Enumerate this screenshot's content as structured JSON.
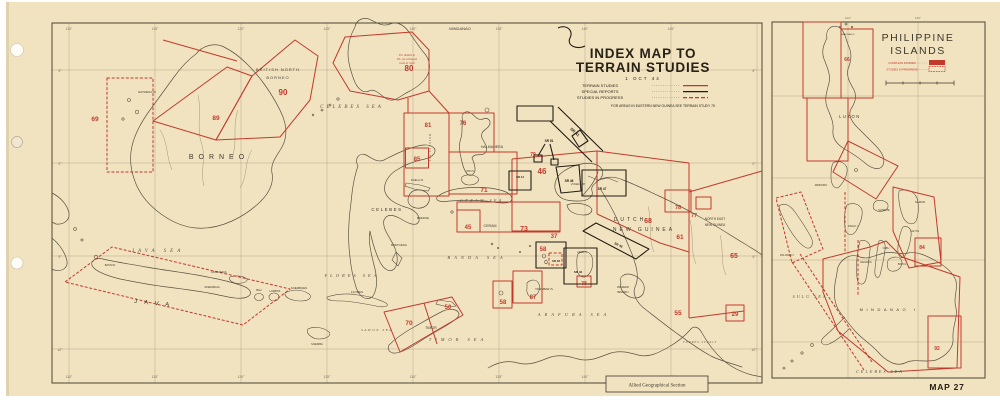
{
  "sheet": {
    "map_number": "MAP 27",
    "credit": "Allied Geographical Section"
  },
  "colors": {
    "paper": "#f2e3c0",
    "map_line": "#5a5343",
    "study_red": "#c13a2c",
    "report_black": "#221d14"
  },
  "main_map": {
    "title_line1": "INDEX MAP TO",
    "title_line2": "TERRAIN STUDIES",
    "date": "1 OCT 44",
    "legend": {
      "terrain_studies": "TERRAIN STUDIES",
      "special_reports": "SPECIAL REPORTS",
      "studies_in_progress": "STUDIES IN PROGRESS"
    },
    "footnote": "FOR AREAS IN EASTERN NEW GUINEA SEE TERRAIN STUDY 79",
    "inset_note": [
      "For details in",
      "P.I. see enlarged",
      "inset at right"
    ],
    "sea_labels": [
      "CELEBES SEA",
      "JAVA SEA",
      "FLORES SEA",
      "BANDA SEA",
      "CERAM SEA",
      "TIMOR SEA",
      "ARAFURA SEA",
      "SAWOE SEA",
      "TORRES STRAIT",
      "MOLUCCA SEA"
    ],
    "place_labels": [
      "BORNEO",
      "BRITISH NORTH",
      "BORNEO",
      "NATOENA IS",
      "MINDANAO",
      "CELEBES",
      "HALMAHERA",
      "CERAM",
      "BOEROE",
      "SOELA IS",
      "BOETOENG",
      "MADOERA",
      "JAVA",
      "BALI",
      "LOMBOK",
      "SOEMBAWA",
      "FLORES",
      "SOEMBA",
      "TIMOR",
      "TANIMBAR IS",
      "DUTCH",
      "NEW GUINEA",
      "NORTH EAST",
      "NEW GUINEA",
      "VOGELKOP",
      "FREDERIK",
      "HENDRIK I",
      "OBI IS",
      "AROE IS",
      "BATAVIA",
      "SOERABAJA"
    ],
    "study_numbers": [
      "90",
      "89",
      "69",
      "80",
      "81",
      "85",
      "76",
      "71",
      "79",
      "46",
      "45",
      "73",
      "37",
      "68",
      "61",
      "65",
      "78",
      "77",
      "70",
      "50",
      "58",
      "87",
      "58",
      "38",
      "55",
      "29"
    ],
    "sr_labels": [
      "SR 41",
      "SR 51",
      "SR 44",
      "SR 46",
      "SR 47",
      "SR 45",
      "SR 42",
      "SR 48"
    ],
    "lon_ticks": [
      "110°",
      "115°",
      "120°",
      "125°",
      "130°",
      "135°",
      "140°",
      "145°"
    ],
    "lat_ticks": [
      "5°",
      "0°",
      "5°",
      "10°"
    ]
  },
  "inset": {
    "title_line1": "PHILIPPINE",
    "title_line2": "ISLANDS",
    "legend": {
      "complete": "COMPLETE STUDIES",
      "in_progress": "STUDIES IN PROGRESS"
    },
    "labels": [
      "LUZON",
      "MINDORO",
      "PANAY I",
      "SAMAR",
      "MASBATE",
      "LEYTE",
      "NEGROS",
      "CEBU",
      "BOHOL",
      "PALAWAN I",
      "MINDANAO I",
      "SULU SEA",
      "CELEBES SEA",
      "BABUYAN IS"
    ],
    "numbers": [
      "66",
      "84",
      "92"
    ],
    "lon_ticks": [
      "120°",
      "125°"
    ]
  }
}
